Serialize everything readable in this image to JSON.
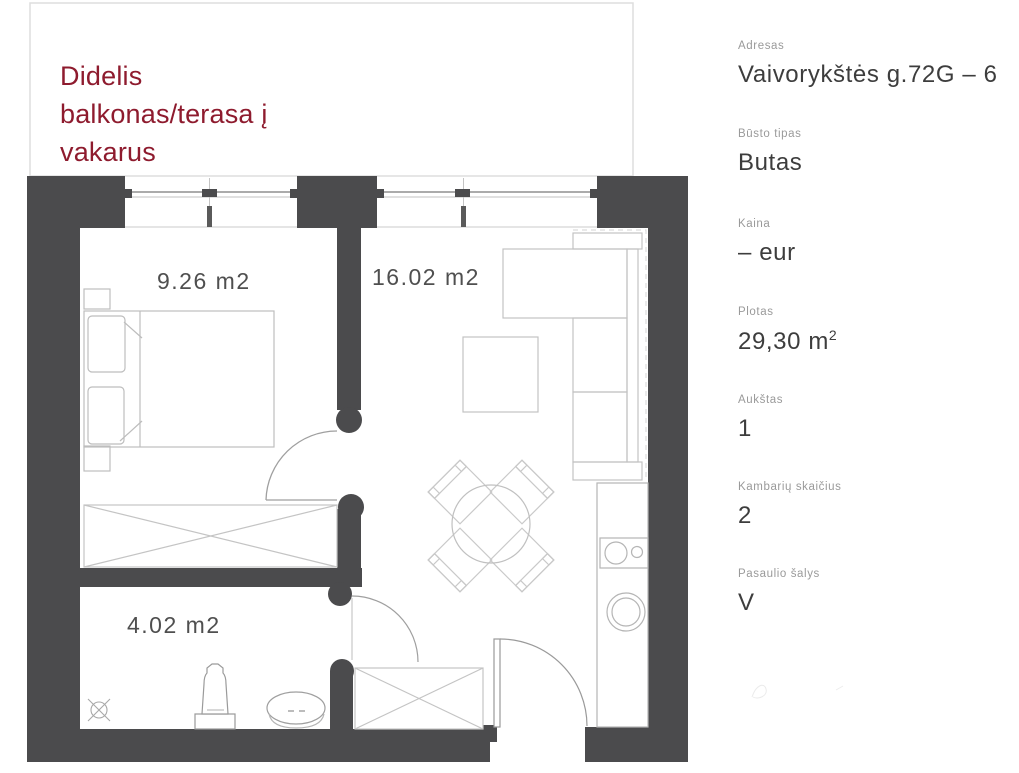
{
  "page": {
    "background": "#ffffff"
  },
  "balcony_note": {
    "lines": [
      "Didelis",
      "balkonas/terasa į",
      "vakarus"
    ],
    "color": "#8e1b2e"
  },
  "floorplan": {
    "wall_color": "#4b4b4d",
    "room_labels": {
      "bedroom": "9.26 m2",
      "living": "16.02 m2",
      "bathroom": "4.02 m2"
    }
  },
  "sidebar": {
    "fields": [
      {
        "label": "Adresas",
        "value": "Vaivorykštės g.72G – 6"
      },
      {
        "label": "Būsto tipas",
        "value": "Butas"
      },
      {
        "label": "Kaina",
        "value": "– eur"
      },
      {
        "label": "Plotas",
        "value": "29,30 m",
        "sup": "2"
      },
      {
        "label": "Aukštas",
        "value": "1"
      },
      {
        "label": "Kambarių skaičius",
        "value": "2"
      },
      {
        "label": "Pasaulio šalys",
        "value": "V"
      }
    ]
  }
}
